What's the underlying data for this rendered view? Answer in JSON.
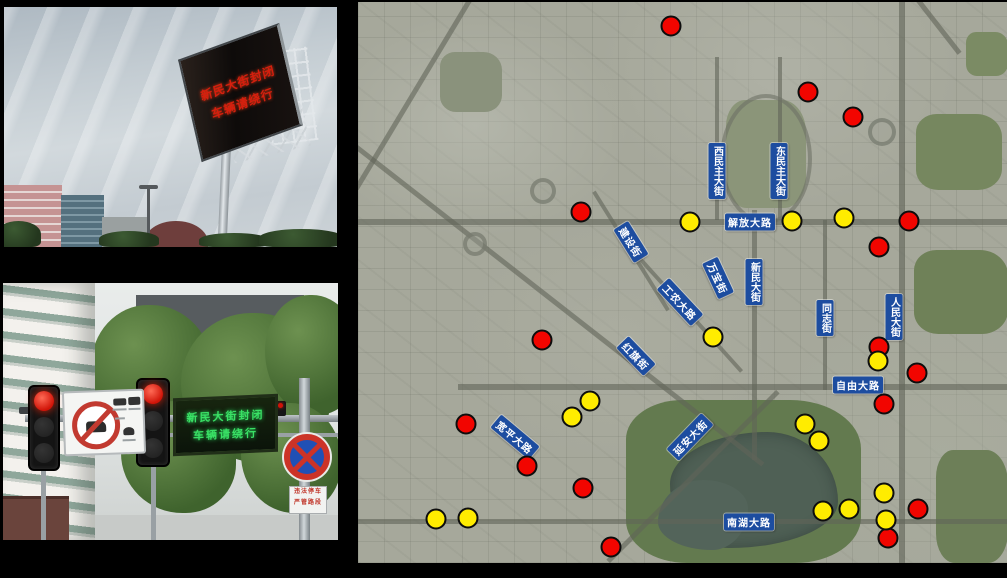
{
  "photos": {
    "billboard": {
      "led_lines": [
        "新民大街封闭",
        "车辆请绕行"
      ],
      "led_color": "#d61f0e"
    },
    "street_sign": {
      "led_lines": [
        "新民大街封闭",
        "车辆请绕行"
      ],
      "led_color": "#3ae065",
      "plate_lines": [
        "违法停车",
        "严管路段"
      ]
    }
  },
  "map": {
    "marker_colors": {
      "red": "#f20500",
      "yellow": "#ffec00"
    },
    "label_style": {
      "bg": "#1d4da0",
      "text": "#ffffff"
    },
    "street_labels": [
      {
        "text": "西民主大街",
        "x": 359,
        "y": 169,
        "mode": "vertical",
        "angle": 0
      },
      {
        "text": "东民主大街",
        "x": 421,
        "y": 169,
        "mode": "vertical",
        "angle": 0
      },
      {
        "text": "解放大路",
        "x": 392,
        "y": 220,
        "mode": "horizontal",
        "angle": 0
      },
      {
        "text": "新民大街",
        "x": 396,
        "y": 280,
        "mode": "vertical",
        "angle": 0
      },
      {
        "text": "万宝街",
        "x": 360,
        "y": 276,
        "mode": "rotated",
        "angle": 65
      },
      {
        "text": "建设街",
        "x": 273,
        "y": 240,
        "mode": "rotated",
        "angle": 58
      },
      {
        "text": "工农大路",
        "x": 322,
        "y": 300,
        "mode": "rotated",
        "angle": 47
      },
      {
        "text": "同志街",
        "x": 467,
        "y": 316,
        "mode": "vertical",
        "angle": 0
      },
      {
        "text": "人民大街",
        "x": 536,
        "y": 315,
        "mode": "vertical",
        "angle": 0
      },
      {
        "text": "自由大路",
        "x": 500,
        "y": 383,
        "mode": "horizontal",
        "angle": 0
      },
      {
        "text": "红旗街",
        "x": 278,
        "y": 354,
        "mode": "rotated",
        "angle": 46
      },
      {
        "text": "宽平大路",
        "x": 157,
        "y": 435,
        "mode": "rotated",
        "angle": 40
      },
      {
        "text": "延安大街",
        "x": 332,
        "y": 435,
        "mode": "rotated",
        "angle": -46
      },
      {
        "text": "南湖大路",
        "x": 391,
        "y": 520,
        "mode": "horizontal",
        "angle": 0
      }
    ],
    "markers": {
      "red": [
        [
          313,
          24
        ],
        [
          450,
          90
        ],
        [
          495,
          115
        ],
        [
          223,
          210
        ],
        [
          551,
          219
        ],
        [
          521,
          245
        ],
        [
          184,
          338
        ],
        [
          521,
          345
        ],
        [
          559,
          371
        ],
        [
          526,
          402
        ],
        [
          108,
          422
        ],
        [
          169,
          464
        ],
        [
          225,
          486
        ],
        [
          560,
          507
        ],
        [
          530,
          536
        ],
        [
          253,
          545
        ]
      ],
      "yellow": [
        [
          332,
          220
        ],
        [
          434,
          219
        ],
        [
          486,
          216
        ],
        [
          355,
          335
        ],
        [
          520,
          359
        ],
        [
          232,
          399
        ],
        [
          214,
          415
        ],
        [
          447,
          422
        ],
        [
          461,
          439
        ],
        [
          526,
          491
        ],
        [
          465,
          509
        ],
        [
          491,
          507
        ],
        [
          528,
          518
        ],
        [
          78,
          517
        ],
        [
          110,
          516
        ]
      ]
    }
  }
}
